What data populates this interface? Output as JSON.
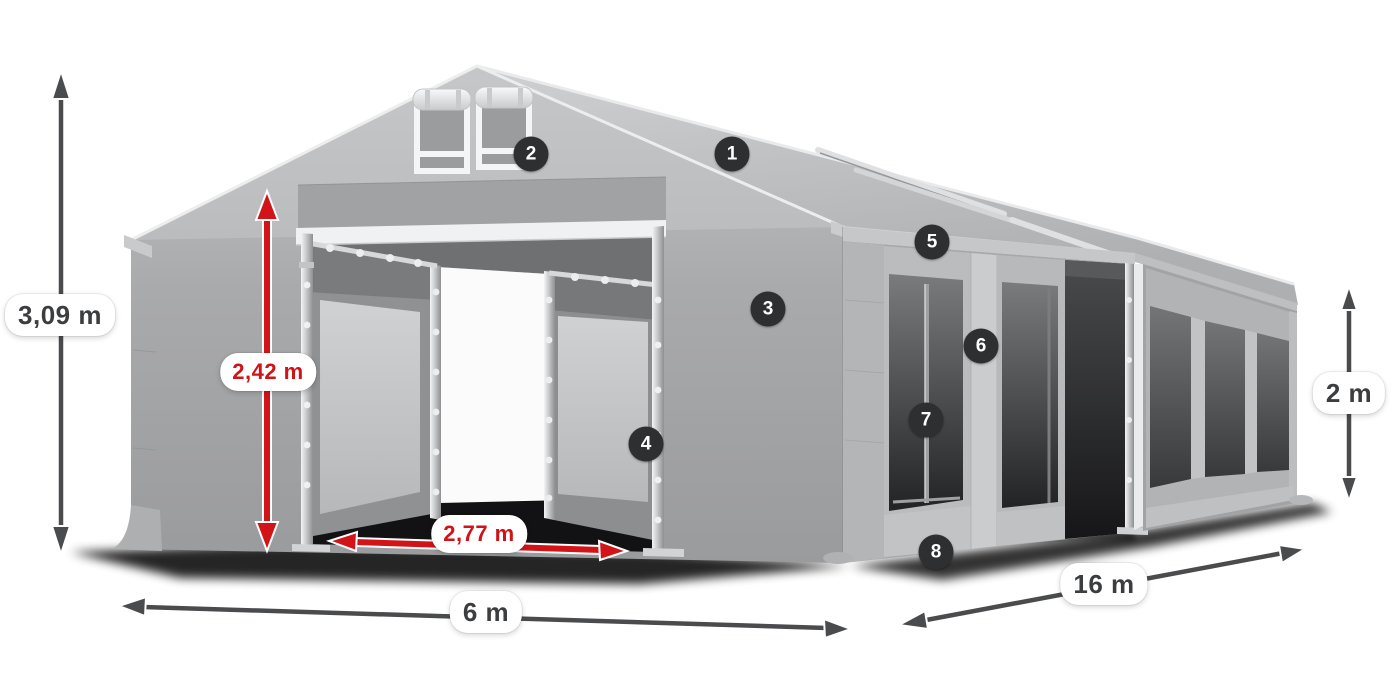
{
  "diagram": {
    "background_color": "#ffffff",
    "subject": "Gable storage/party tent shown in perspective with dimension arrows and numbered feature hotspots",
    "dimensions": {
      "total_height": {
        "label": "3,09 m",
        "style": "dark"
      },
      "entrance_height": {
        "label": "2,42 m",
        "style": "red"
      },
      "entrance_width": {
        "label": "2,77 m",
        "style": "red"
      },
      "front_width": {
        "label": "6 m",
        "style": "dark"
      },
      "side_length": {
        "label": "16 m",
        "style": "dark"
      },
      "side_wall_height": {
        "label": "2 m",
        "style": "dark"
      }
    },
    "hotspots": [
      {
        "number": "1"
      },
      {
        "number": "2"
      },
      {
        "number": "3"
      },
      {
        "number": "4"
      },
      {
        "number": "5"
      },
      {
        "number": "6"
      },
      {
        "number": "7"
      },
      {
        "number": "8"
      }
    ],
    "colors": {
      "dimension_arrow_dark": "#4a4b4d",
      "dimension_arrow_red": "#d21419",
      "label_text_dark": "#3c3d3f",
      "label_text_red": "#cf1318",
      "badge_background": "#2e2f31",
      "badge_text": "#ffffff",
      "tent_fabric_light": "#c6c7c9",
      "tent_fabric_mid": "#a8a9ab",
      "window_dark": "#3a3b3d"
    }
  }
}
